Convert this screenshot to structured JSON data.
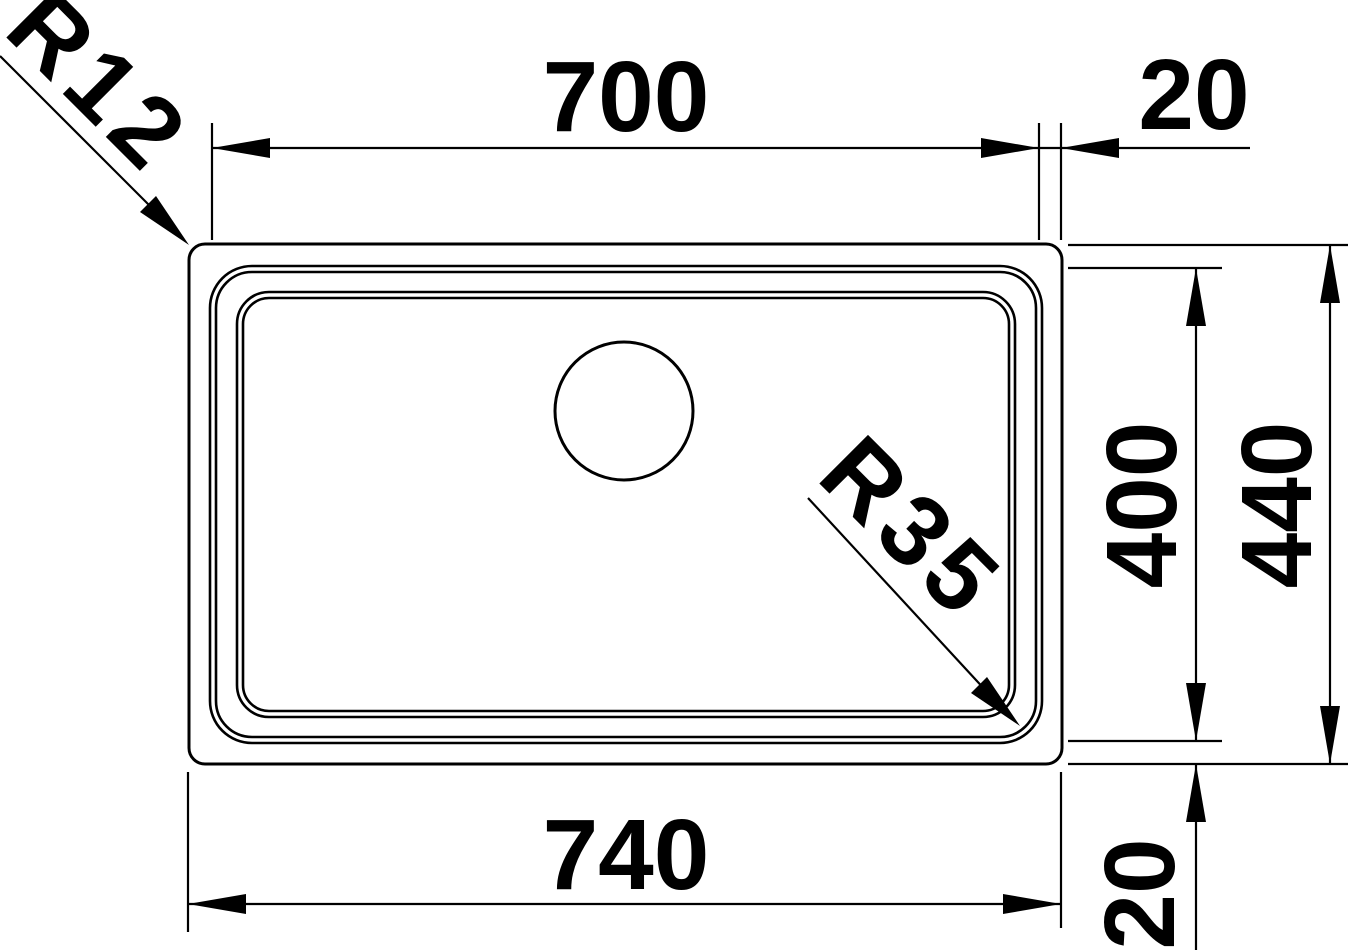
{
  "drawing": {
    "background_color": "#ffffff",
    "line_color": "#000000",
    "labels": {
      "top_width": "700",
      "top_right_offset": "20",
      "inner_height": "400",
      "outer_height": "440",
      "bottom_width": "740",
      "bottom_right_offset": "20",
      "radius_outer_corner": "R12",
      "radius_bowl_corner": "R35"
    }
  }
}
